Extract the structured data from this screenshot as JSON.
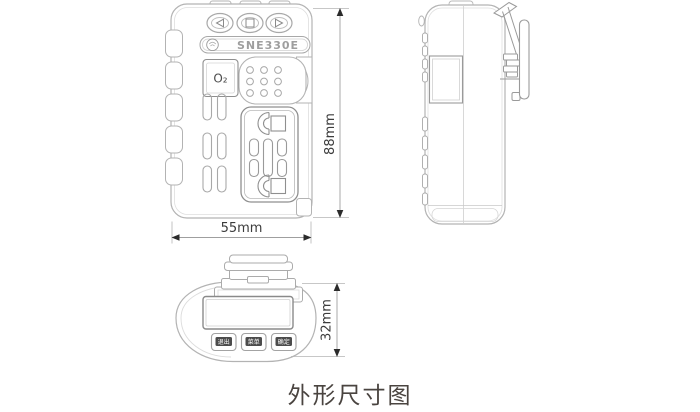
{
  "title": "外形尺寸图",
  "front_view": {
    "model": "SNE330E",
    "gas_badge": "O₂",
    "nav_buttons": [
      {
        "icon": "triangle-left"
      },
      {
        "icon": "square"
      },
      {
        "icon": "triangle-right"
      }
    ]
  },
  "bottom_view": {
    "buttons": [
      {
        "label": "退出"
      },
      {
        "label": "菜单"
      },
      {
        "label": "确定"
      }
    ]
  },
  "dimensions": {
    "height": "88mm",
    "width": "55mm",
    "depth": "32mm"
  },
  "colors": {
    "outline": "#b3b3b3",
    "outline_dark": "#8f8f8f",
    "dim_text": "#3c3c3c",
    "title_text": "#4a4440",
    "badge_bg": "#4c4c4c",
    "badge_text": "#ffffff"
  }
}
